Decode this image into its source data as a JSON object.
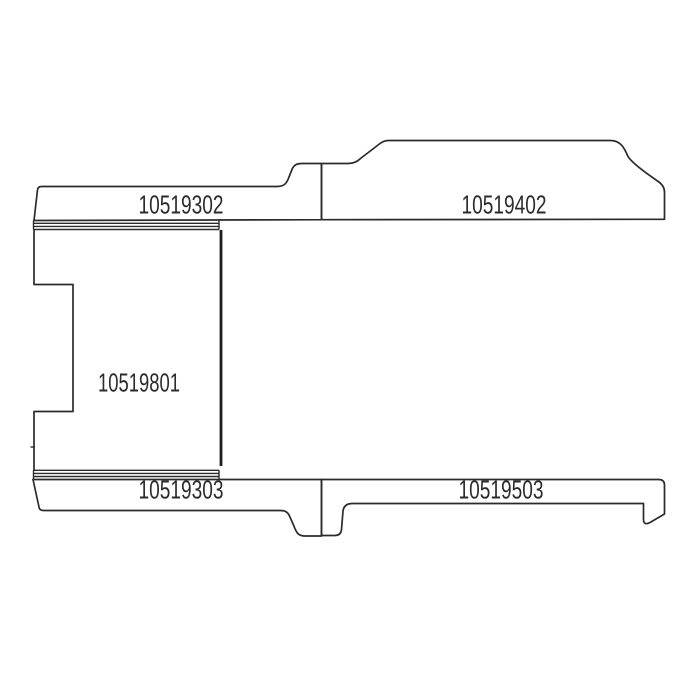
{
  "diagram": {
    "background": "#ffffff",
    "line_color": "#2b2b2d",
    "parts": [
      {
        "label": "10519302",
        "position": "top-left-strip"
      },
      {
        "label": "10519402",
        "position": "top-right-strip"
      },
      {
        "label": "10519801",
        "position": "center-panel"
      },
      {
        "label": "10519303",
        "position": "bottom-left-strip"
      },
      {
        "label": "10519503",
        "position": "bottom-right-strip"
      }
    ]
  }
}
